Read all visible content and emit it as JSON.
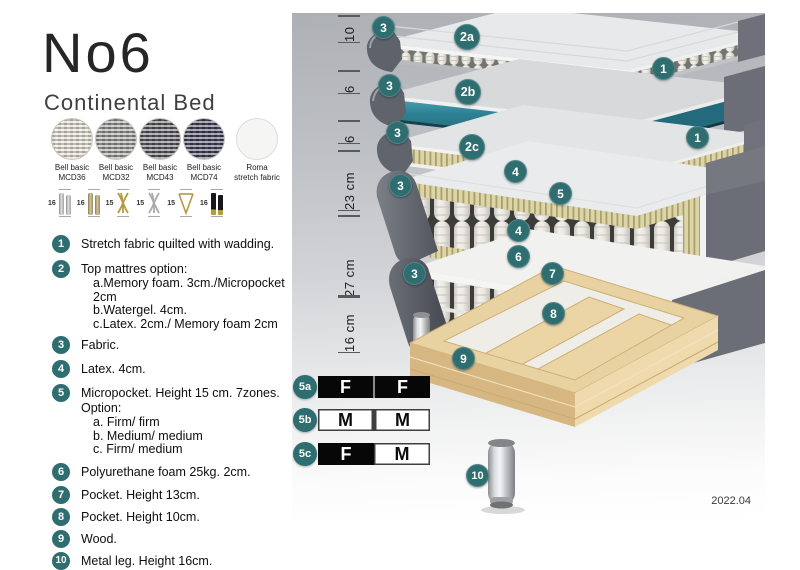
{
  "header": {
    "title": "No6",
    "subtitle": "Continental Bed"
  },
  "swatches": [
    {
      "line1": "Bell basic",
      "line2": "MCD36"
    },
    {
      "line1": "Bell basic",
      "line2": "MCD32"
    },
    {
      "line1": "Bell basic",
      "line2": "MCD43"
    },
    {
      "line1": "Bell basic",
      "line2": "MCD74"
    },
    {
      "line1": "Roma",
      "line2": "stretch fabric"
    }
  ],
  "legs": [
    {
      "height": "16",
      "style": "cylinder-silver"
    },
    {
      "height": "16",
      "style": "cylinder-brass"
    },
    {
      "height": "15",
      "style": "cross-gold"
    },
    {
      "height": "15",
      "style": "cross-silver"
    },
    {
      "height": "15",
      "style": "hairpin-gold"
    },
    {
      "height": "16",
      "style": "straight-black-gold-tip"
    }
  ],
  "legend": [
    {
      "num": "1",
      "text": "Stretch fabric quilted with wadding."
    },
    {
      "num": "2",
      "text": "Top mattres option:",
      "sub": [
        "a.Memory foam. 3cm./Micropocket 2cm",
        "b.Watergel. 4cm.",
        "c.Latex. 2cm./ Memory foam 2cm"
      ]
    },
    {
      "num": "3",
      "text": "Fabric."
    },
    {
      "num": "4",
      "text": "Latex. 4cm."
    },
    {
      "num": "5",
      "text": "Micropocket. Height 15 cm. 7zones. Option:",
      "sub": [
        "a. Firm/ firm",
        "b. Medium/ medium",
        "c. Firm/ medium"
      ]
    },
    {
      "num": "6",
      "text": "Polyurethane foam 25kg. 2cm."
    },
    {
      "num": "7",
      "text": "Pocket. Height 13cm."
    },
    {
      "num": "8",
      "text": "Pocket. Height 10cm."
    },
    {
      "num": "9",
      "text": "Wood."
    },
    {
      "num": "10",
      "text": "Metal leg. Height 16cm."
    }
  ],
  "diagram": {
    "measurements": [
      "10",
      "6",
      "6",
      "23 cm",
      "27 cm",
      "16 cm"
    ],
    "callouts": [
      "3",
      "2a",
      "1",
      "3",
      "2b",
      "1",
      "3",
      "2c",
      "3",
      "4",
      "5",
      "4",
      "6",
      "3",
      "7",
      "8",
      "9",
      "10"
    ],
    "firmness": [
      {
        "label": "5a",
        "cells": [
          {
            "text": "F",
            "tone": "dark"
          },
          {
            "text": "F",
            "tone": "dark"
          }
        ]
      },
      {
        "label": "5b",
        "cells": [
          {
            "text": "M",
            "tone": "light"
          },
          {
            "text": "M",
            "tone": "light"
          }
        ]
      },
      {
        "label": "5c",
        "cells": [
          {
            "text": "F",
            "tone": "dark"
          },
          {
            "text": "M",
            "tone": "light"
          }
        ]
      }
    ],
    "version": "2022.04"
  },
  "colors": {
    "accent_teal": "#2e6d70",
    "watergel": "#2b7d8f",
    "panel_top": "#adb0b5",
    "wood": "#e8d0a0"
  }
}
